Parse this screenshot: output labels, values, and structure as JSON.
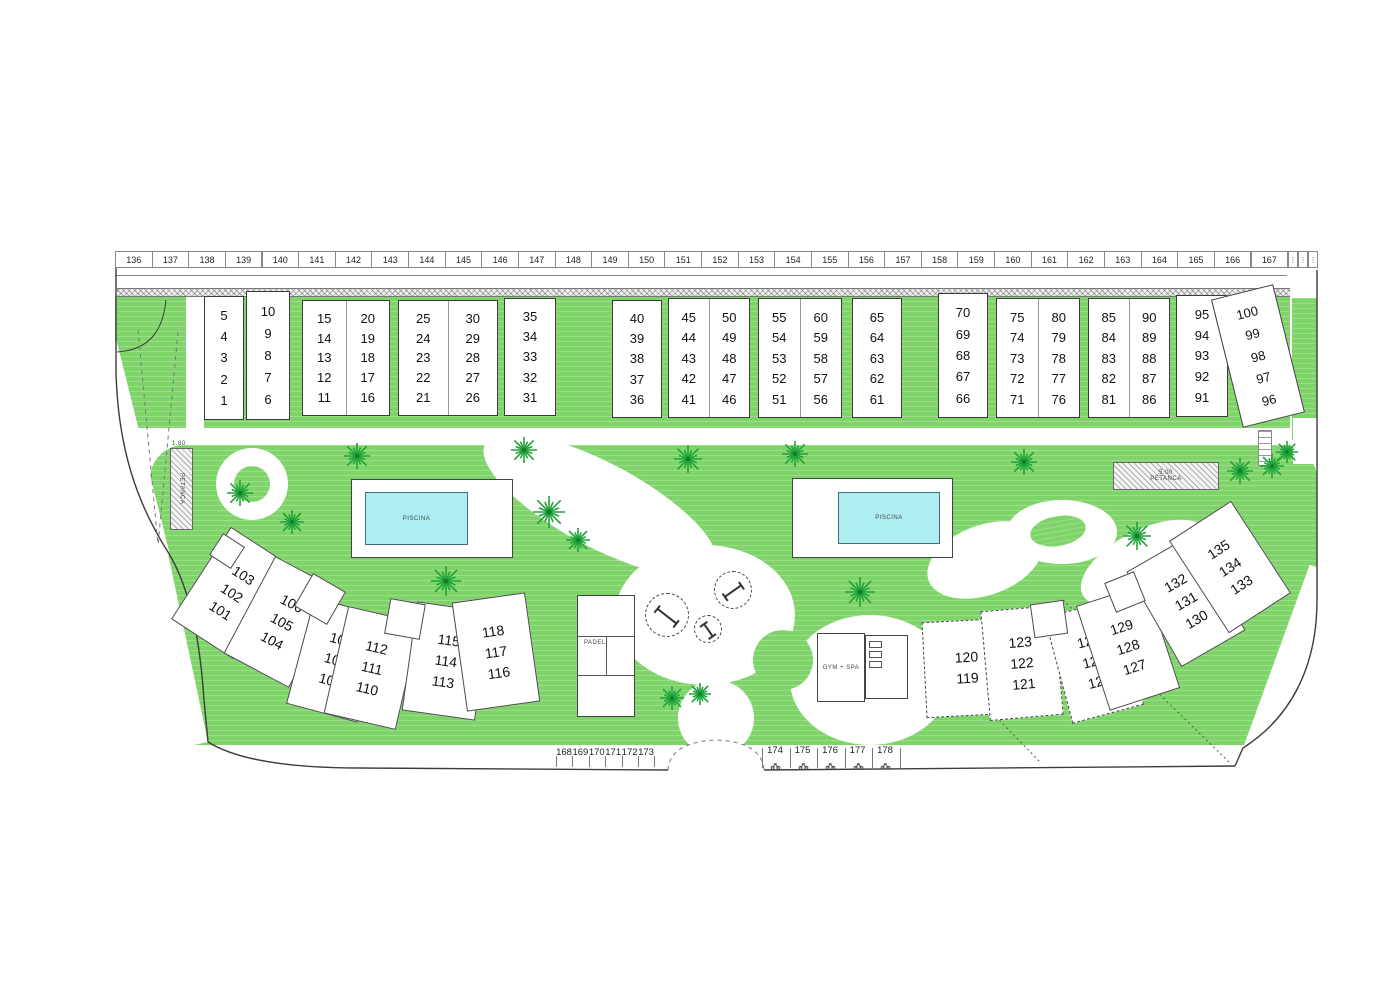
{
  "plan": {
    "colors": {
      "green": "#7fd469",
      "tree_green": "#1fa33a",
      "pool_water": "#aeeef2",
      "outline": "#444444"
    },
    "top_parking": {
      "numbers": [
        "136",
        "137",
        "138",
        "139",
        "140",
        "141",
        "142",
        "143",
        "144",
        "145",
        "146",
        "147",
        "148",
        "149",
        "150",
        "151",
        "152",
        "153",
        "154",
        "155",
        "156",
        "157",
        "158",
        "159",
        "160",
        "161",
        "162",
        "163",
        "164",
        "165",
        "166",
        "167"
      ],
      "moto_slot_count": 3,
      "moto_slot_glyph": "⋮"
    },
    "top_buildings": [
      {
        "x": 204,
        "y": 296,
        "w": 40,
        "h": 124,
        "cols": [
          [
            "5",
            "4",
            "3",
            "2",
            "1"
          ]
        ]
      },
      {
        "x": 246,
        "y": 291,
        "w": 44,
        "h": 129,
        "cols": [
          [
            "10",
            "9",
            "8",
            "7",
            "6"
          ]
        ]
      },
      {
        "x": 302,
        "y": 300,
        "w": 88,
        "h": 116,
        "cols": [
          [
            "15",
            "14",
            "13",
            "12",
            "11"
          ],
          [
            "20",
            "19",
            "18",
            "17",
            "16"
          ]
        ]
      },
      {
        "x": 398,
        "y": 300,
        "w": 100,
        "h": 116,
        "cols": [
          [
            "25",
            "24",
            "23",
            "22",
            "21"
          ],
          [
            "30",
            "29",
            "28",
            "27",
            "26"
          ]
        ]
      },
      {
        "x": 504,
        "y": 298,
        "w": 52,
        "h": 118,
        "cols": [
          [
            "35",
            "34",
            "33",
            "32",
            "31"
          ]
        ]
      },
      {
        "x": 612,
        "y": 300,
        "w": 50,
        "h": 118,
        "cols": [
          [
            "40",
            "39",
            "38",
            "37",
            "36"
          ]
        ]
      },
      {
        "x": 668,
        "y": 298,
        "w": 82,
        "h": 120,
        "cols": [
          [
            "45",
            "44",
            "43",
            "42",
            "41"
          ],
          [
            "50",
            "49",
            "48",
            "47",
            "46"
          ]
        ]
      },
      {
        "x": 758,
        "y": 298,
        "w": 84,
        "h": 120,
        "cols": [
          [
            "55",
            "54",
            "53",
            "52",
            "51"
          ],
          [
            "60",
            "59",
            "58",
            "57",
            "56"
          ]
        ]
      },
      {
        "x": 852,
        "y": 298,
        "w": 50,
        "h": 120,
        "cols": [
          [
            "65",
            "64",
            "63",
            "62",
            "61"
          ]
        ]
      },
      {
        "x": 938,
        "y": 293,
        "w": 50,
        "h": 125,
        "cols": [
          [
            "70",
            "69",
            "68",
            "67",
            "66"
          ]
        ]
      },
      {
        "x": 996,
        "y": 298,
        "w": 84,
        "h": 120,
        "cols": [
          [
            "75",
            "74",
            "73",
            "72",
            "71"
          ],
          [
            "80",
            "79",
            "78",
            "77",
            "76"
          ]
        ]
      },
      {
        "x": 1088,
        "y": 298,
        "w": 82,
        "h": 120,
        "cols": [
          [
            "85",
            "84",
            "83",
            "82",
            "81"
          ],
          [
            "90",
            "89",
            "88",
            "87",
            "86"
          ]
        ]
      },
      {
        "x": 1176,
        "y": 295,
        "w": 52,
        "h": 122,
        "cols": [
          [
            "95",
            "94",
            "93",
            "92",
            "91"
          ]
        ]
      },
      {
        "x": 1226,
        "y": 290,
        "w": 64,
        "h": 132,
        "rot": -14,
        "cols": [
          [
            "100",
            "99",
            "98",
            "97",
            "96"
          ]
        ]
      }
    ],
    "bottom_buildings": [
      {
        "nums": [
          "103",
          "102",
          "101"
        ],
        "cx": 232,
        "cy": 593,
        "rot": 33
      },
      {
        "nums": [
          "106",
          "105",
          "104"
        ],
        "cx": 282,
        "cy": 622,
        "rot": 28
      },
      {
        "nums": [
          "109",
          "108",
          "107"
        ],
        "cx": 336,
        "cy": 660,
        "rot": 15
      },
      {
        "nums": [
          "112",
          "111",
          "110"
        ],
        "cx": 372,
        "cy": 668,
        "rot": 13
      },
      {
        "nums": [
          "115",
          "114",
          "113"
        ],
        "cx": 446,
        "cy": 661,
        "rot": 8
      },
      {
        "nums": [
          "118",
          "117",
          "116"
        ],
        "cx": 496,
        "cy": 652,
        "rot": -8
      },
      {
        "nums": [
          "120",
          "119"
        ],
        "cx": 967,
        "cy": 668,
        "rot": -3,
        "dashed": true,
        "w": 86,
        "h": 96
      },
      {
        "nums": [
          "123",
          "122",
          "121"
        ],
        "cx": 1022,
        "cy": 663,
        "rot": -5,
        "dashed": true
      },
      {
        "nums": [
          "126",
          "125",
          "124"
        ],
        "cx": 1094,
        "cy": 661,
        "rot": -15,
        "dashed": true
      },
      {
        "nums": [
          "129",
          "128",
          "127"
        ],
        "cx": 1128,
        "cy": 647,
        "rot": -18
      },
      {
        "nums": [
          "132",
          "131",
          "130"
        ],
        "cx": 1186,
        "cy": 601,
        "rot": -30
      },
      {
        "nums": [
          "135",
          "134",
          "133"
        ],
        "cx": 1230,
        "cy": 567,
        "rot": -33
      }
    ],
    "cores": [
      {
        "cx": 227,
        "cy": 551,
        "rot": 33,
        "s": 26
      },
      {
        "cx": 320,
        "cy": 599,
        "rot": 30,
        "s": 38
      },
      {
        "cx": 405,
        "cy": 619,
        "rot": 10,
        "s": 36
      },
      {
        "cx": 1049,
        "cy": 619,
        "rot": -8,
        "s": 34
      },
      {
        "cx": 1125,
        "cy": 592,
        "rot": -22,
        "s": 32
      }
    ],
    "amenities": {
      "pool_label": "PISCINA",
      "petanca_label": "PETANCA",
      "petanca_dim": "5.00",
      "petanca_strip_dim": "1.80",
      "padel_label": "PADEL",
      "gym_label": "GYM + SPA"
    },
    "bottom_parking": {
      "left": [
        "168",
        "169",
        "170",
        "171",
        "172",
        "173"
      ],
      "right": [
        "174",
        "175",
        "176",
        "177",
        "178"
      ]
    },
    "trees": [
      [
        357,
        456,
        26
      ],
      [
        524,
        450,
        26
      ],
      [
        688,
        459,
        28
      ],
      [
        795,
        454,
        26
      ],
      [
        1024,
        462,
        26
      ],
      [
        1272,
        466,
        24
      ],
      [
        1240,
        471,
        26
      ],
      [
        1287,
        452,
        22
      ],
      [
        240,
        493,
        26
      ],
      [
        292,
        522,
        24
      ],
      [
        446,
        581,
        30
      ],
      [
        549,
        512,
        32
      ],
      [
        578,
        540,
        24
      ],
      [
        860,
        592,
        30
      ],
      [
        1137,
        536,
        28
      ],
      [
        672,
        698,
        24
      ],
      [
        700,
        694,
        22
      ]
    ],
    "playground": [
      {
        "cx": 667,
        "cy": 615,
        "r": 22,
        "angle": 38
      },
      {
        "cx": 733,
        "cy": 590,
        "r": 19,
        "angle": -35
      },
      {
        "cx": 708,
        "cy": 629,
        "r": 14,
        "angle": 55
      }
    ]
  }
}
